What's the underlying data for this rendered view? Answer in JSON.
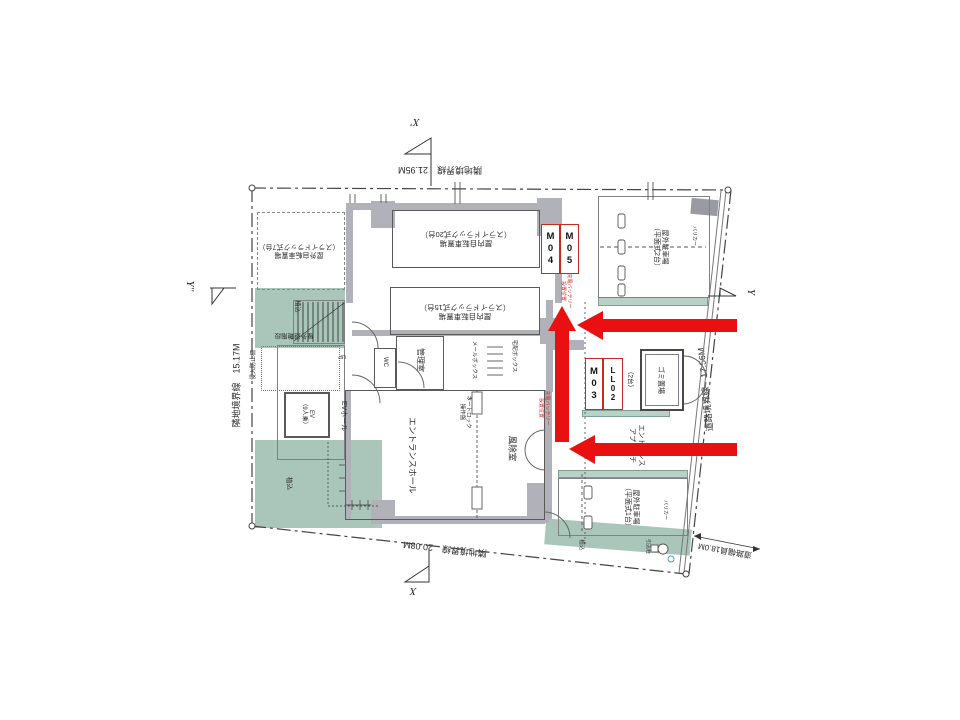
{
  "colors": {
    "arrow_red": "#e81010",
    "tag_border_red": "#c92a1e",
    "note_red": "#cc2222",
    "greenery": "#aac6bb",
    "wall_gray": "#b1b1b9"
  },
  "boundaries": {
    "top": "隣地境界線　21.95M",
    "left": "隣地境界線　15.17M",
    "right": "道路境界線　17.56M",
    "bottom": "隣地境界線　20.08M",
    "road_width": "道路幅員18.0M"
  },
  "axes": {
    "x_top": "X'",
    "x_bottom": "X",
    "y_left": "Y''",
    "y_right": "Y"
  },
  "tags": {
    "m04": "M04",
    "m05": "M05",
    "m03": "M03",
    "ll02": "LL02"
  },
  "labels": {
    "bike_out7": "屋外自転車置場\n（スライドラック式7台）",
    "bike_in20": "屋内自転車置場\n（スライドラック式20台）",
    "bike_in15": "屋内自転車置場\n（スライドラック式15台）",
    "park2": "屋外駐車場\n（平面式2台）",
    "park1": "屋外駐車場\n（平面式1台）",
    "hall": "エントランスホール",
    "windbreak": "風除室",
    "manager": "管理室",
    "wc": "WC",
    "ev": "EV\n（9人乗）",
    "ev_hall": "EVホール",
    "garbage": "ゴミ置場",
    "mail": "メールボックス",
    "delivery": "宅配ボックス",
    "autolock": "オートロック\n操作盤",
    "esc_stair": "屋外避難階段",
    "up": "UP",
    "fence": "侵入防止柵",
    "two_units": "（2台）",
    "approach": "エントランス\nアプローチ",
    "planting": "植込",
    "pole": "引込柱",
    "bollard": "バリカー",
    "charge": "充電バッテリー\n設置位置"
  }
}
